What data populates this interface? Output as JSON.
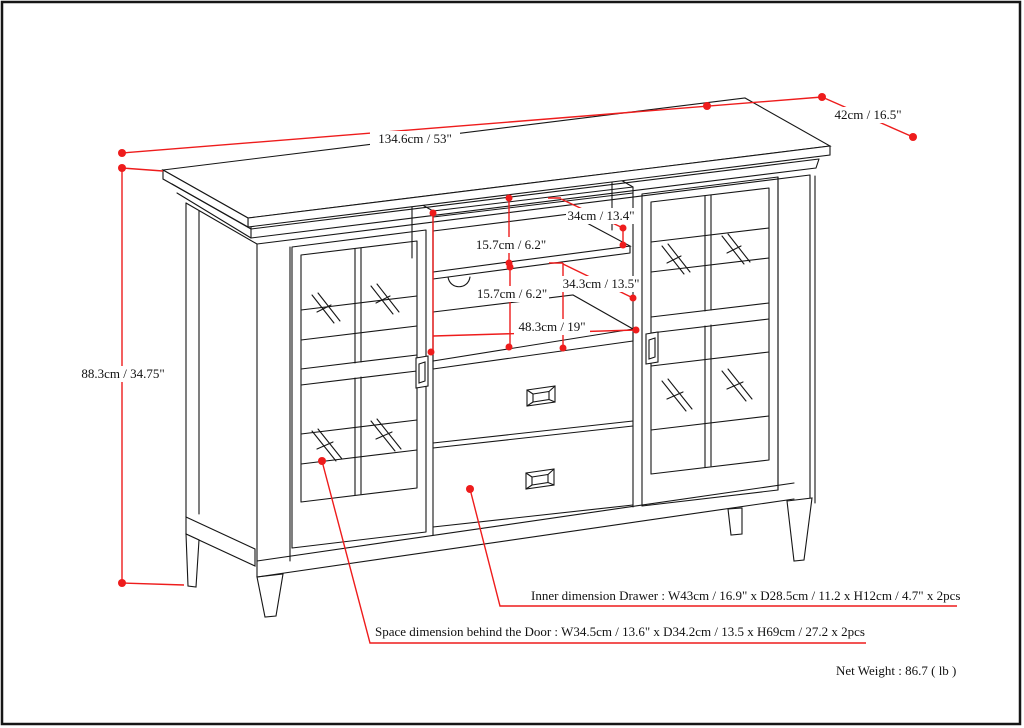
{
  "diagram": {
    "dimensions": {
      "top_width": "134.6cm / 53\"",
      "top_depth": "42cm / 16.5\"",
      "overall_height": "88.3cm / 34.75\"",
      "upper_shelf_depth": "34cm / 13.4\"",
      "upper_shelf_clearance": "15.7cm / 6.2\"",
      "lower_shelf_depth": "34.3cm / 13.5\"",
      "lower_shelf_clearance": "15.7cm / 6.2\"",
      "opening_width": "48.3cm / 19\""
    },
    "notes": {
      "drawer": "Inner dimension Drawer : W43cm / 16.9\" x D28.5cm / 11.2 x H12cm / 4.7\" x 2pcs",
      "door": "Space dimension behind the Door  : W34.5cm / 13.6\" x D34.2cm / 13.5 x H69cm / 27.2 x 2pcs",
      "net_weight": "Net Weight : 86.7 ( lb )"
    },
    "colors": {
      "dimension_red": "#ee1c1c",
      "line_black": "#161616",
      "background": "#ffffff"
    }
  }
}
